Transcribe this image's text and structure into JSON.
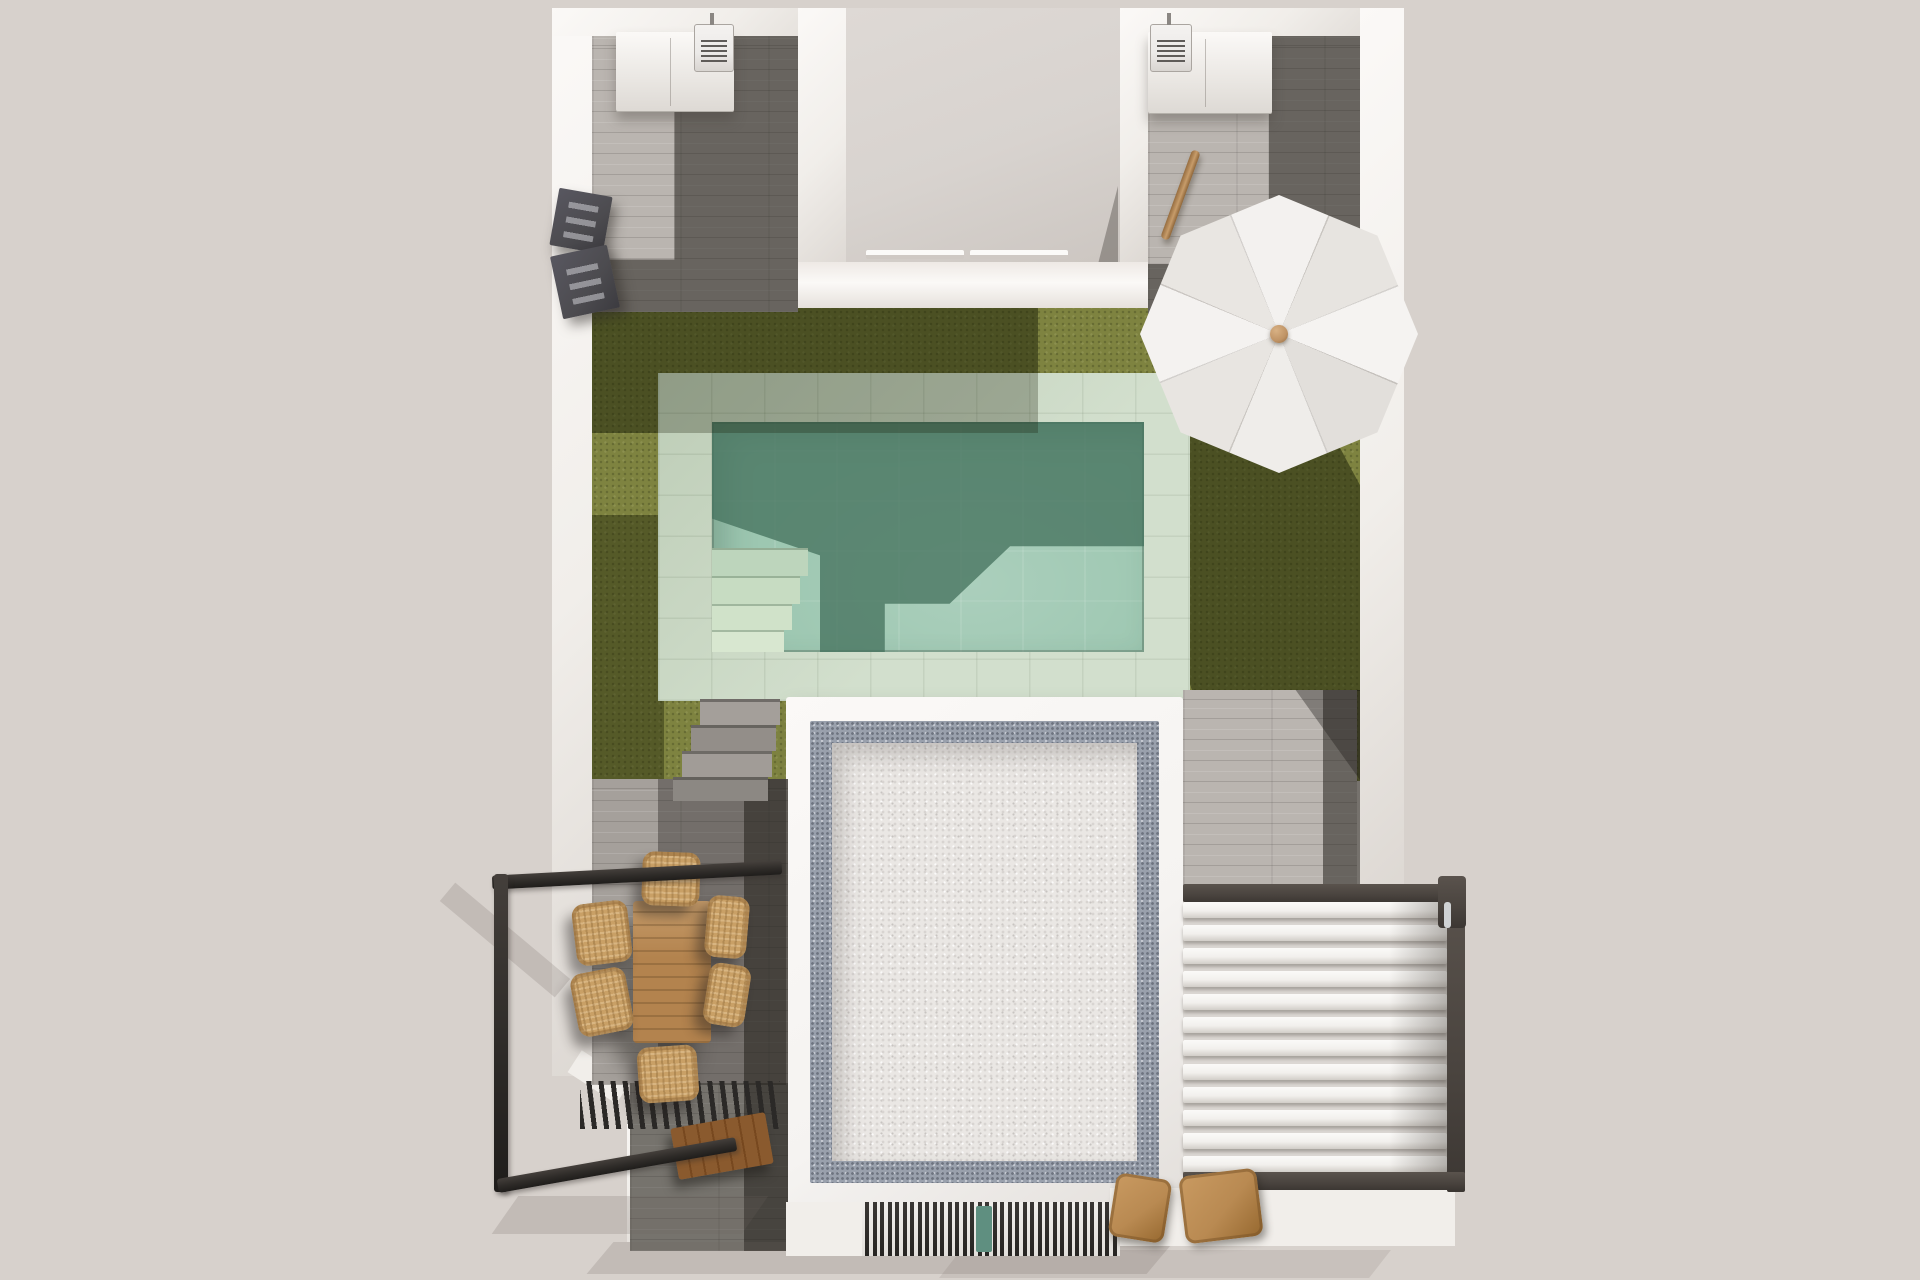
{
  "title": "Top-down 3D architectural render: villa plot with pool, lawn, roof terraces, dining porch and pergolas",
  "palette": {
    "bg": "#d7d1cc",
    "wall": "#f1eeea",
    "wall_bright": "#fbf9f7",
    "wall_shade": "#ddd8d3",
    "courtyard": "#d8d3cf",
    "tile_light": "#bab5b0",
    "tile_mid": "#a5a09b",
    "tile_dark_overlay": "rgba(28,26,22,0.52)",
    "plank_line": "rgba(60,56,52,0.18)",
    "grass": "#7e8340",
    "grass_shadow": "rgba(24,30,6,0.5)",
    "coping": "#cbdac5",
    "water": "#9dc7b1",
    "water_dark": "#47735f",
    "roof_gravel": "#eae7e4",
    "roof_speckle": "#99a0ac",
    "roof_parapet": "#f5f3f1",
    "pergola_frame": "#4a443f",
    "louver": "#f2f0ed",
    "railing": "#2e2b28",
    "table_wood": "#b3834e",
    "wicker": "#c9a066",
    "bench_wood": "#8a5a2e",
    "lounge_wood": "#b98a52",
    "umbrella": "#edebe8",
    "umbrella_knob": "#bf9365",
    "gate": "#4c4b4f",
    "ac_body": "#eceae8",
    "mat_teal": "#5f8f80",
    "step_concrete": "#a09c97",
    "shadow_soft": "rgba(110,102,94,0.2)"
  },
  "scene": {
    "pergola": {
      "slat_count": 12
    },
    "grate": {
      "slat_count": 34
    },
    "umbrella": {
      "cx": 1279,
      "cy": 334,
      "radius": 139,
      "gores": 8
    },
    "sprites": [
      {
        "name": "storage-cabinet-left",
        "cls": "cabinet",
        "x": 616,
        "y": 32,
        "w": 118,
        "h": 80
      },
      {
        "name": "ac-unit-left",
        "cls": "ac",
        "x": 694,
        "y": 24,
        "w": 38,
        "h": 46
      },
      {
        "name": "storage-cabinet-right",
        "cls": "cabinet",
        "x": 1148,
        "y": 32,
        "w": 124,
        "h": 82
      },
      {
        "name": "ac-unit-right",
        "cls": "ac",
        "x": 1150,
        "y": 24,
        "w": 40,
        "h": 46
      },
      {
        "name": "gate-panel-upper",
        "cls": "gate",
        "x": 554,
        "y": 192,
        "w": 54,
        "h": 58,
        "rot": 10
      },
      {
        "name": "gate-panel-lower",
        "cls": "gate",
        "x": 556,
        "y": 250,
        "w": 58,
        "h": 64,
        "rot": -12
      },
      {
        "name": "wood-pole",
        "cls": "pole",
        "x": 1176,
        "y": 148,
        "w": 9,
        "h": 94,
        "rot": 20
      },
      {
        "name": "dining-table",
        "cls": "table",
        "x": 633,
        "y": 901,
        "w": 78,
        "h": 142
      },
      {
        "name": "dining-chair-top",
        "cls": "wicker",
        "x": 642,
        "y": 852,
        "w": 58,
        "h": 54,
        "rot": 2
      },
      {
        "name": "dining-chair-bottom",
        "cls": "wicker",
        "x": 638,
        "y": 1046,
        "w": 60,
        "h": 56,
        "rot": -4
      },
      {
        "name": "dining-chair-left-1",
        "cls": "wicker",
        "x": 574,
        "y": 902,
        "w": 56,
        "h": 62,
        "rot": -7
      },
      {
        "name": "dining-chair-left-2",
        "cls": "wicker",
        "x": 574,
        "y": 970,
        "w": 56,
        "h": 64,
        "rot": -11
      },
      {
        "name": "dining-chair-right-1",
        "cls": "wicker",
        "x": 706,
        "y": 896,
        "w": 42,
        "h": 62,
        "rot": 5
      },
      {
        "name": "dining-chair-right-2",
        "cls": "wicker",
        "x": 706,
        "y": 964,
        "w": 42,
        "h": 62,
        "rot": 9
      },
      {
        "name": "wood-bench",
        "cls": "bench",
        "x": 674,
        "y": 1120,
        "w": 96,
        "h": 52,
        "rot": -10
      },
      {
        "name": "lounge-chair-left",
        "cls": "lounge",
        "x": 1112,
        "y": 1176,
        "w": 56,
        "h": 64,
        "rot": 9
      },
      {
        "name": "lounge-chair-right",
        "cls": "lounge",
        "x": 1182,
        "y": 1172,
        "w": 78,
        "h": 68,
        "rot": -7
      },
      {
        "name": "pool-step-1",
        "cls": "pool-step",
        "x": 712,
        "y": 548,
        "w": 96,
        "h": 28,
        "bg": "#bdd5bc"
      },
      {
        "name": "pool-step-2",
        "cls": "pool-step",
        "x": 712,
        "y": 576,
        "w": 88,
        "h": 28,
        "bg": "#c7dcc2"
      },
      {
        "name": "pool-step-3",
        "cls": "pool-step",
        "x": 712,
        "y": 604,
        "w": 80,
        "h": 26,
        "bg": "#d0e2c9"
      },
      {
        "name": "pool-step-4",
        "cls": "pool-step",
        "x": 712,
        "y": 630,
        "w": 72,
        "h": 22,
        "bg": "#d8e7d0"
      },
      {
        "name": "garden-step-1",
        "cls": "step",
        "x": 700,
        "y": 699,
        "w": 80,
        "h": 26,
        "bg": "#a49f9a"
      },
      {
        "name": "garden-step-2",
        "cls": "step",
        "x": 691,
        "y": 725,
        "w": 85,
        "h": 26,
        "bg": "#938e89"
      },
      {
        "name": "garden-step-3",
        "cls": "step",
        "x": 682,
        "y": 751,
        "w": 90,
        "h": 26,
        "bg": "#a19c97"
      },
      {
        "name": "garden-step-4",
        "cls": "step",
        "x": 673,
        "y": 777,
        "w": 95,
        "h": 24,
        "bg": "#8c8883"
      },
      {
        "name": "door-mat",
        "cls": "mat",
        "x": 976,
        "y": 1206,
        "w": 16,
        "h": 46
      }
    ]
  }
}
